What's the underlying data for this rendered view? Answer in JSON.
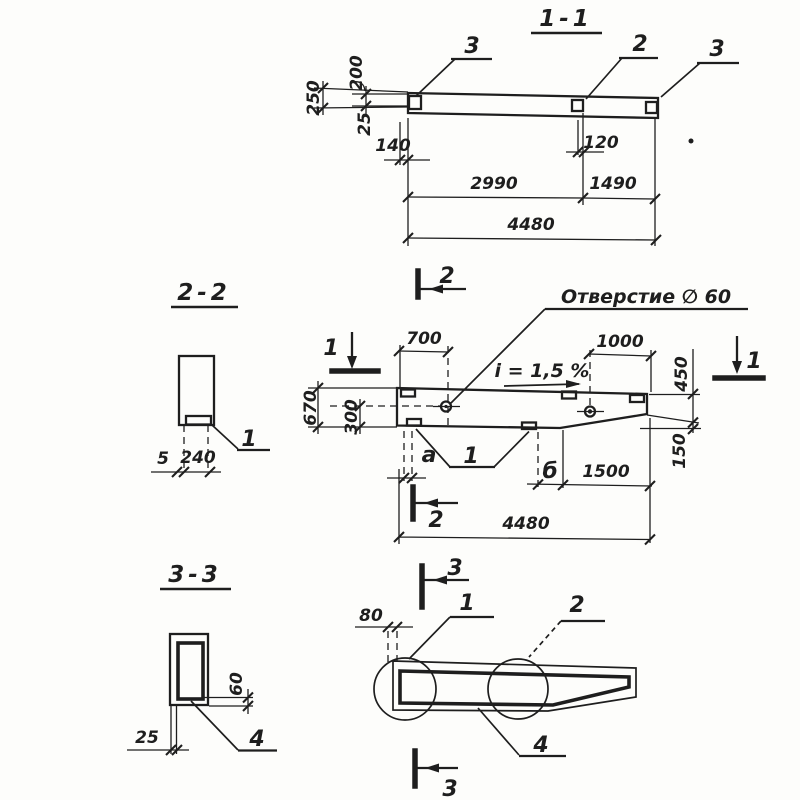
{
  "colors": {
    "ink": "#1e1e1e",
    "paper": "#fdfdfb"
  },
  "section_1_1": {
    "title": "1-1",
    "callout_left": "3",
    "callout_mid": "2",
    "callout_right": "3",
    "dim_250": "250",
    "dim_200": "200",
    "dim_25": "25",
    "dim_140": "140",
    "dim_120": "120",
    "dim_2990": "2990",
    "dim_1490": "1490",
    "dim_4480": "4480"
  },
  "section_2_2": {
    "title": "2-2",
    "dim_5": "5",
    "dim_240": "240",
    "callout_1": "1"
  },
  "elevation": {
    "marker_top": "2",
    "marker_bottom": "2",
    "marker_left": "1",
    "marker_right": "1",
    "hole_label": "Отверстие ∅ 60",
    "slope_label": "i = 1,5 %",
    "dim_700": "700",
    "dim_1000": "1000",
    "dim_670": "670",
    "dim_300": "300",
    "dim_450": "450",
    "dim_150": "150",
    "label_a": "а",
    "label_b": "б",
    "dim_1500": "1500",
    "dim_4480": "4480",
    "callout_1": "1"
  },
  "section_3_3": {
    "title": "3-3",
    "dim_60": "60",
    "dim_25": "25",
    "callout_4": "4"
  },
  "bottom_view": {
    "marker_top": "3",
    "marker_bottom": "3",
    "dim_80": "80",
    "callout_1": "1",
    "callout_2": "2",
    "callout_4": "4"
  }
}
